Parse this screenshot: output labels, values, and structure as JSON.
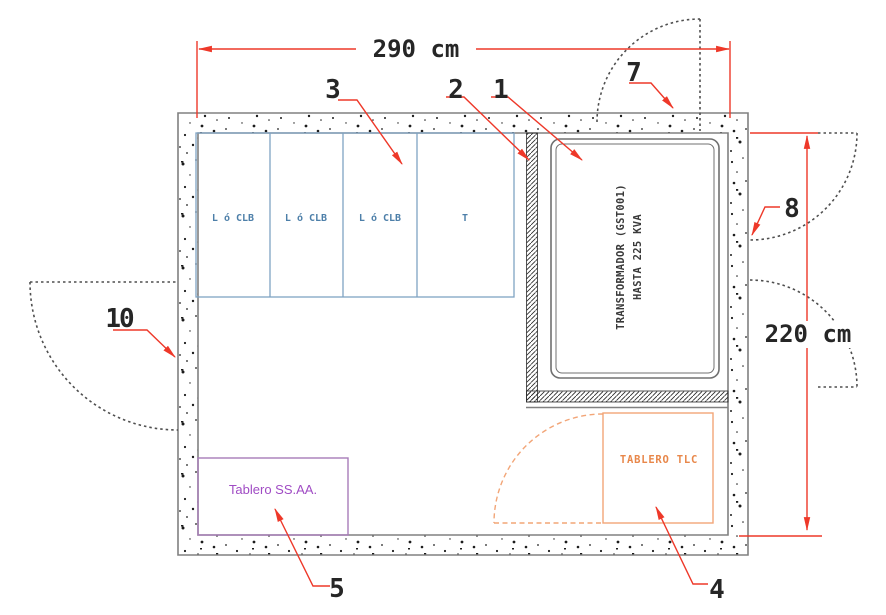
{
  "diagram": {
    "dimension_width": "290 cm",
    "dimension_height": "220 cm"
  },
  "callouts": {
    "c1": "1",
    "c2": "2",
    "c3": "3",
    "c4": "4",
    "c5": "5",
    "c7": "7",
    "c8": "8",
    "c10": "10"
  },
  "switchgear_cells": {
    "cell1": "L ó CLB",
    "cell2": "L ó CLB",
    "cell3": "L ó CLB",
    "cell4": "T"
  },
  "transformer": {
    "line1": "TRANSFORMADOR (GST001)",
    "line2": "HASTA 225 KVA"
  },
  "panels": {
    "tlc": "TABLERO TLC",
    "ssaa": "Tablero SS.AA."
  },
  "colors": {
    "annotation_red": "#ee3829",
    "cell_blue": "#7fa3c2",
    "panel_orange": "#f2a577",
    "panel_purple": "#a77cb8",
    "wall_gray": "#808080"
  }
}
